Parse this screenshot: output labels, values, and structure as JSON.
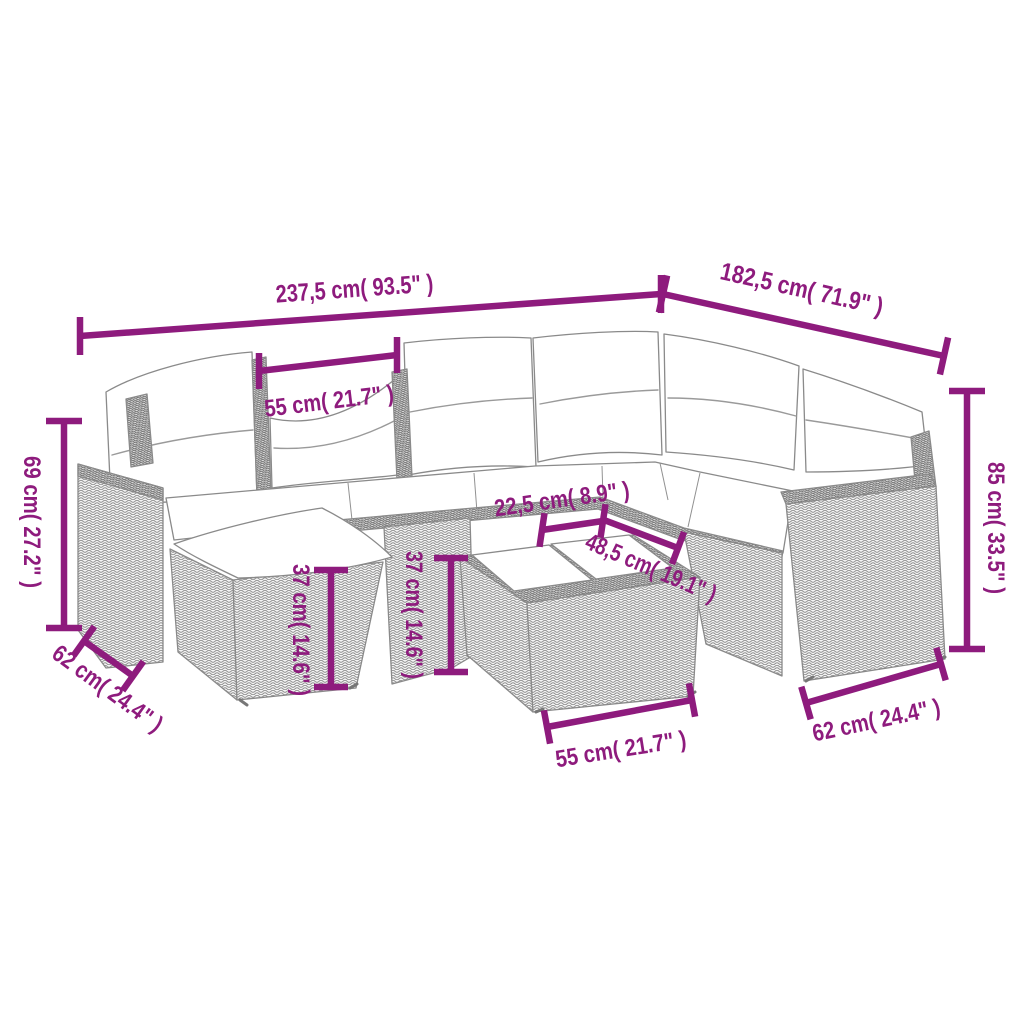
{
  "figure": {
    "type": "product-dimension-diagram",
    "subject": "Poly rattan corner sofa set line drawing with white cushions, footstool and coffee table"
  },
  "colors": {
    "dimension_accent": "#8E1B7D",
    "line_art_gray": "#8A8A8A",
    "cushion_fill": "#FFFFFF",
    "background": "#FFFFFF"
  },
  "annotations": {
    "overall_width": "237,5 cm( 93.5\" )",
    "overall_depth": "182,5 cm( 71.9\" )",
    "back_section_width": "55 cm( 21.7\" )",
    "backrest_height": "69 cm( 27.2\" )",
    "stool_depth": "62 cm( 24.4\" )",
    "stool_height": "37 cm( 14.6\" )",
    "seat_height": "37 cm( 14.6\" )",
    "seat_gap": "22,5 cm( 8.9\" )",
    "table_depth": "48,5 cm( 19.1\" )",
    "table_width": "55 cm( 21.7\" )",
    "armrest_depth": "62 cm( 24.4\" )",
    "overall_height": "85 cm( 33.5\" )"
  }
}
